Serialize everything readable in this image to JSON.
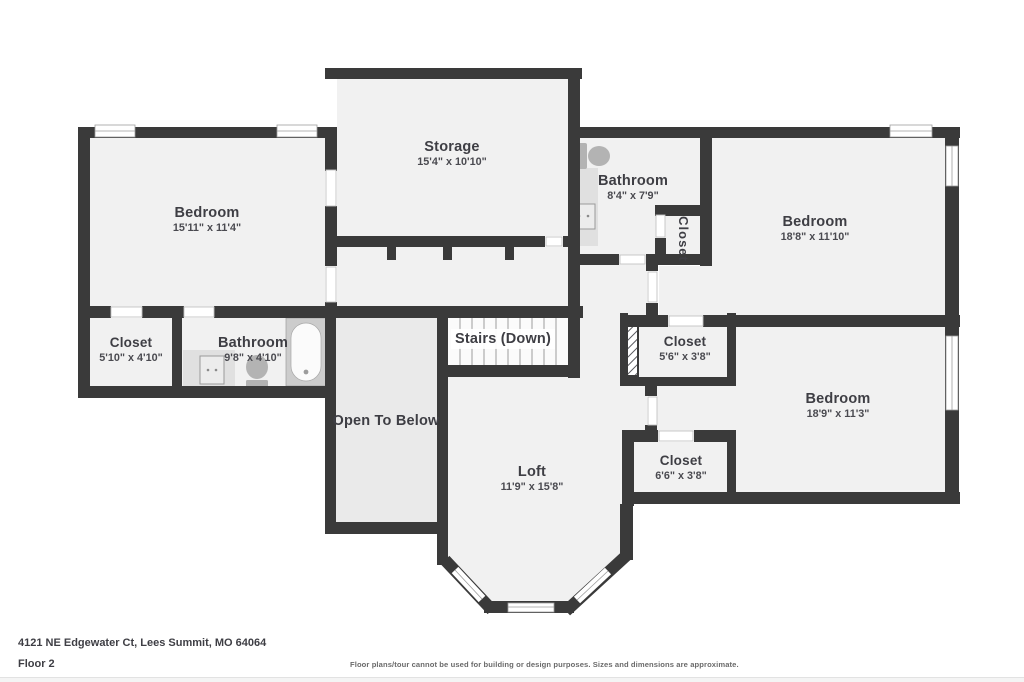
{
  "title": "Second floor plan",
  "rooms": [
    {
      "id": "bedroom-1",
      "name": "Bedroom",
      "dims": "15'11\" x 11'4\""
    },
    {
      "id": "storage",
      "name": "Storage",
      "dims": "15'4\" x 10'10\""
    },
    {
      "id": "bathroom-1",
      "name": "Bathroom",
      "dims": "8'4\" x 7'9\""
    },
    {
      "id": "closet-hall",
      "name": "Closet",
      "dims": ""
    },
    {
      "id": "bedroom-2",
      "name": "Bedroom",
      "dims": "18'8\" x 11'10\""
    },
    {
      "id": "closet-1",
      "name": "Closet",
      "dims": "5'10\" x 4'10\""
    },
    {
      "id": "bathroom-2",
      "name": "Bathroom",
      "dims": "9'8\" x 4'10\""
    },
    {
      "id": "open-to-below",
      "name": "Open To Below",
      "dims": ""
    },
    {
      "id": "stairs",
      "name": "Stairs (Down)",
      "dims": ""
    },
    {
      "id": "loft",
      "name": "Loft",
      "dims": "11'9\" x 15'8\""
    },
    {
      "id": "closet-2",
      "name": "Closet",
      "dims": "5'6\" x 3'8\""
    },
    {
      "id": "bedroom-3",
      "name": "Bedroom",
      "dims": "18'9\" x 11'3\""
    },
    {
      "id": "closet-3",
      "name": "Closet",
      "dims": "6'6\" x 3'8\""
    }
  ],
  "footer": {
    "address": "4121 NE Edgewater Ct, Lees Summit, MO 64064",
    "floor_label": "Floor 2",
    "disclaimer": "Floor plans/tour cannot be used for building or design purposes. Sizes and dimensions are approximate."
  },
  "colors": {
    "wall": "#3a3a3a",
    "floor": "#f1f1f1",
    "floor_open_to_below": "#eaeaea",
    "floor_stairs": "#fbfbfb",
    "fixture_gray": "#b3b3b3",
    "counter_gray": "#e0e0e0",
    "text": "#3e3e44"
  }
}
